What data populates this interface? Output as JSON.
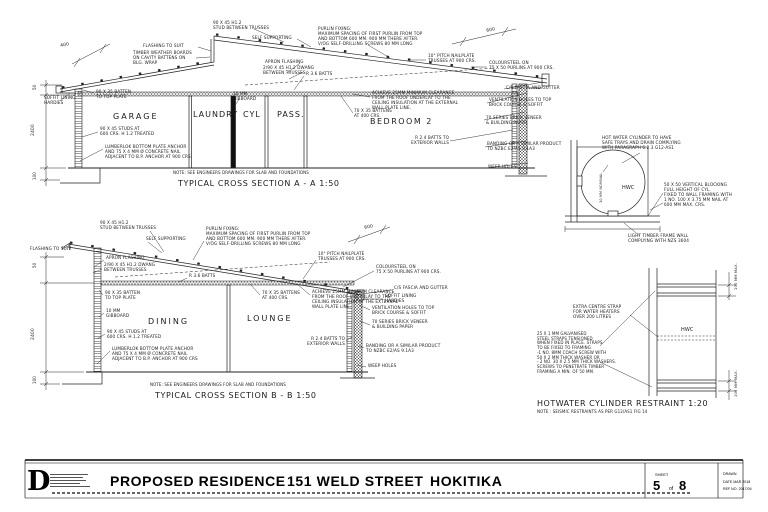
{
  "canvas": {
    "background": "#ffffff",
    "ink": "#222222"
  },
  "annotations": [
    {
      "t": "400",
      "x": 60,
      "y": 44,
      "rot": -12,
      "fs": 4.5,
      "name": "dim-400"
    },
    {
      "t": "FLASHING TO SUIT",
      "x": 143,
      "y": 44,
      "name": "note-flashing"
    },
    {
      "t": "TIMBER WEATHER BOARDS\nON CAVITY BATTENS ON\nBLG. WRAP",
      "x": 133,
      "y": 51,
      "name": "note-weatherboards"
    },
    {
      "t": "90 X 45 H1.2\nSTUD BETWEEN TRUSSES",
      "x": 213,
      "y": 21,
      "name": "note-stud-trusses"
    },
    {
      "t": "SELF SUPPORTING",
      "x": 252,
      "y": 36,
      "name": "note-self-supporting"
    },
    {
      "t": "PURLIN FIXING:\nMAXIMUM SPACING OF FIRST PURLIN FROM TOP\nAND BOTTOM 600 MM. 900 MM THERE AFTER.\nV/OG SELF-DRILLING SCREWS 80 MM LONG",
      "x": 318,
      "y": 27,
      "name": "note-purlin-fixing"
    },
    {
      "t": "600",
      "x": 486,
      "y": 29,
      "rot": -12,
      "fs": 4.5,
      "name": "dim-600"
    },
    {
      "t": "APRON FLASHING",
      "x": 265,
      "y": 60,
      "name": "note-apron-flashing"
    },
    {
      "t": "2/90 X 45 H1.2 DWANG\nBETWEEN TRUSSES",
      "x": 263,
      "y": 66,
      "name": "note-dwang"
    },
    {
      "t": "R 3.6 BATTS",
      "x": 306,
      "y": 72,
      "name": "note-ceiling-batts"
    },
    {
      "t": "10° PITCH NAILPLATE\nTRUSSES AT 900 CRS.",
      "x": 428,
      "y": 54,
      "name": "note-nailplate-trusses"
    },
    {
      "t": "COLOURSTEEL ON\n75 X 50 PURLINS AT 900 CRS.",
      "x": 489,
      "y": 61,
      "name": "note-coloursteel"
    },
    {
      "t": "C/S FASCIA AND GUTTER",
      "x": 506,
      "y": 86,
      "name": "note-fascia"
    },
    {
      "t": "VENTILATION HOLES TO TOP\nBRICK COURSE & SOFFIT",
      "x": 489,
      "y": 98,
      "name": "note-ventilation"
    },
    {
      "t": "70 SERIES BRICK VENEER\n& BUILDING PAPER",
      "x": 486,
      "y": 116,
      "name": "note-brick-veneer"
    },
    {
      "t": "R 2.4 BATTS TO\nEXTERIOR WALLS",
      "x": 411,
      "y": 136,
      "ta": "right",
      "w": 38,
      "name": "note-wall-batts"
    },
    {
      "t": "BANDING OR A SIMILAR PRODUCT\nTO NZBC E2/AS 9.1A3",
      "x": 487,
      "y": 142,
      "name": "note-banding"
    },
    {
      "t": "WEEP HOLES",
      "x": 488,
      "y": 165,
      "name": "note-weep-holes"
    },
    {
      "t": "SOFFIT LINING\nHARDIES",
      "x": 44,
      "y": 96,
      "name": "note-soffit-lining"
    },
    {
      "t": "90 X 35 BATTEN\nTO TOP PLATE",
      "x": 96,
      "y": 90,
      "name": "note-batten-top-plate"
    },
    {
      "t": "10 MM\nGIBBOARD",
      "x": 233,
      "y": 92,
      "name": "note-gibboard"
    },
    {
      "t": "70 X 35 BATTENS\nAT 400 CRS.",
      "x": 354,
      "y": 109,
      "name": "note-ceiling-battens"
    },
    {
      "t": "ACHIEVE 25MM MINIMUM CLEARANCE\nFROM THE ROOF UNDERLAY TO THE\nCEILING INSULATION AT THE EXTERNAL\nWALL PLATE LINE.",
      "x": 372,
      "y": 91,
      "name": "note-clearance"
    },
    {
      "t": "90 X 45 STUDS AT\n600 CRS. H 1.2 TREATED",
      "x": 100,
      "y": 127,
      "name": "note-studs"
    },
    {
      "t": "LUMBERLOK BOTTOM PLATE ANCHOR\nAND 75 X 4 MM Ø CONCRETE NAIL\nADJACENT TO B.P. ANCHOR AT 900 CRS",
      "x": 105,
      "y": 145,
      "name": "note-lumberlok"
    },
    {
      "t": "GARAGE",
      "x": 113,
      "y": 112,
      "fs": 8,
      "ls": 2,
      "name": "room-label-garage"
    },
    {
      "t": "LAUNDRY",
      "x": 193,
      "y": 110,
      "fs": 8,
      "ls": 1,
      "name": "room-label-laundry"
    },
    {
      "t": "CYL",
      "x": 243,
      "y": 110,
      "fs": 8,
      "ls": 1,
      "name": "room-label-cyl"
    },
    {
      "t": "PASS.",
      "x": 277,
      "y": 110,
      "fs": 8,
      "ls": 1,
      "name": "room-label-pass"
    },
    {
      "t": "BEDROOM 2",
      "x": 370,
      "y": 117,
      "fs": 8,
      "ls": 1.5,
      "name": "room-label-bedroom2"
    },
    {
      "t": "NOTE: SEE ENGINEERS DRAWINGS FOR SLAB AND FOUNDATIONS",
      "x": 173,
      "y": 171,
      "fs": 4,
      "name": "section-a-note"
    },
    {
      "t": "TYPICAL CROSS SECTION A - A 1:50",
      "x": 178,
      "y": 179,
      "fs": 8,
      "ls": 0.6,
      "name": "section-a-title"
    },
    {
      "t": "2400",
      "x": 31,
      "y": 136,
      "rot": -90,
      "fs": 4.5,
      "name": "dim-2400"
    },
    {
      "t": "100",
      "x": 33,
      "y": 180,
      "rot": -90,
      "fs": 4,
      "name": "dim-100"
    },
    {
      "t": "50",
      "x": 33,
      "y": 90,
      "rot": -90,
      "fs": 4,
      "name": "dim-50"
    },
    {
      "t": "FLASHING TO SUIT",
      "x": 30,
      "y": 247,
      "name": "note-flashing-b"
    },
    {
      "t": "90 X 45 H1.2\nSTUD BETWEEN TRUSSES",
      "x": 100,
      "y": 221,
      "name": "note-stud-trusses-b"
    },
    {
      "t": "SELF SUPPORTING",
      "x": 146,
      "y": 237,
      "name": "note-self-supporting-b"
    },
    {
      "t": "PURLIN FIXING:\nMAXIMUM SPACING OF FIRST PURLIN FROM TOP\nAND BOTTOM 600 MM. 900 MM THERE AFTER.\nV/OG SELF-DRILLING SCREWS 80 MM LONG",
      "x": 206,
      "y": 227,
      "name": "note-purlin-fixing-b"
    },
    {
      "t": "600",
      "x": 364,
      "y": 226,
      "rot": -12,
      "fs": 4.5,
      "name": "dim-600-b"
    },
    {
      "t": "10° PITCH NAILPLATE\nTRUSSES AT 900 CRS.",
      "x": 318,
      "y": 252,
      "name": "note-nailplate-trusses-b"
    },
    {
      "t": "APRON FLASHING",
      "x": 106,
      "y": 256,
      "name": "note-apron-flashing-b"
    },
    {
      "t": "2/90 X 45 H1.2 DWANG\nBETWEEN TRUSSES",
      "x": 104,
      "y": 263,
      "name": "note-dwang-b"
    },
    {
      "t": "R 3.6 BATTS",
      "x": 189,
      "y": 274,
      "name": "note-ceiling-batts-b"
    },
    {
      "t": "COLOURSTEEL ON\n75 X 50 PURLINS AT 900 CRS.",
      "x": 376,
      "y": 265,
      "name": "note-coloursteel-b"
    },
    {
      "t": "C/S FASCIA AND GUTTER",
      "x": 394,
      "y": 286,
      "name": "note-fascia-b"
    },
    {
      "t": "SOFFIT LINING\nHARDIES",
      "x": 385,
      "y": 294,
      "name": "note-soffit-lining-b"
    },
    {
      "t": "VENTILATION HOLES TO TOP\nBRICK COURSE & SOFFIT",
      "x": 372,
      "y": 306,
      "name": "note-ventilation-b"
    },
    {
      "t": "70 SERIES BRICK VENEER\n& BUILDING PAPER",
      "x": 372,
      "y": 320,
      "name": "note-brick-veneer-b"
    },
    {
      "t": "90 X 35 BATTEN\nTO TOP PLATE",
      "x": 105,
      "y": 291,
      "name": "note-batten-top-plate-b"
    },
    {
      "t": "70 X 35 BATTENS\nAT 400 CRS.",
      "x": 262,
      "y": 291,
      "name": "note-ceiling-battens-b"
    },
    {
      "t": "ACHIEVE 25MM MINIMUM CLEARANCE\nFROM THE ROOF UNDERLAY TO THE\nCEILING INSULATION AT THE EXTERNAL\nWALL PLATE LINE.",
      "x": 312,
      "y": 290,
      "name": "note-clearance-b"
    },
    {
      "t": "10 MM\nGIBBOARD",
      "x": 106,
      "y": 309,
      "name": "note-gibboard-b"
    },
    {
      "t": "DINING",
      "x": 148,
      "y": 317,
      "fs": 8,
      "ls": 2,
      "name": "room-label-dining"
    },
    {
      "t": "LOUNGE",
      "x": 247,
      "y": 314,
      "fs": 8,
      "ls": 2,
      "name": "room-label-lounge"
    },
    {
      "t": "90 X 45 STUDS AT\n600 CRS. H 1.2 TREATED",
      "x": 107,
      "y": 330,
      "name": "note-studs-b"
    },
    {
      "t": "LUMBERLOK BOTTOM PLATE ANCHOR\nAND 75 X 4 MM Ø CONCRETE NAIL\nADJACENT TO B.P. ANCHOR AT 900 CRS",
      "x": 112,
      "y": 347,
      "name": "note-lumberlok-b"
    },
    {
      "t": "R 2.4 BATTS TO\nEXTERIOR WALLS",
      "x": 303,
      "y": 337,
      "ta": "right",
      "w": 42,
      "name": "note-wall-batts-b"
    },
    {
      "t": "BANDING OR A SIMILAR PRODUCT\nTO NZBC E2/AS 9.1A3",
      "x": 366,
      "y": 344,
      "name": "note-banding-b"
    },
    {
      "t": "WEEP HOLES",
      "x": 368,
      "y": 364,
      "name": "note-weep-holes-b"
    },
    {
      "t": "NOTE: SEE ENGINEERS DRAWINGS FOR SLAB AND FOUNDATIONS",
      "x": 150,
      "y": 383,
      "fs": 4,
      "name": "section-b-note"
    },
    {
      "t": "TYPICAL CROSS SECTION B - B 1:50",
      "x": 155,
      "y": 391,
      "fs": 8,
      "ls": 0.6,
      "name": "section-b-title"
    },
    {
      "t": "2400",
      "x": 31,
      "y": 340,
      "rot": -90,
      "fs": 4.5,
      "name": "dim-2400-b"
    },
    {
      "t": "100",
      "x": 33,
      "y": 384,
      "rot": -90,
      "fs": 4,
      "name": "dim-100-b"
    },
    {
      "t": "50",
      "x": 33,
      "y": 268,
      "rot": -90,
      "fs": 4,
      "name": "dim-50-b"
    },
    {
      "t": "HOT WATER CYLINDER TO HAVE\nSAFE TRAYS AND DRAIN COMPLYING\nWITH PARAGRAPH 6.2.3 G12-AS1",
      "x": 602,
      "y": 136,
      "name": "note-hwc-tray"
    },
    {
      "t": "HWC",
      "x": 622,
      "y": 186,
      "fs": 5,
      "name": "hwc-label"
    },
    {
      "t": "10 MM NOMINAL",
      "x": 599,
      "y": 203,
      "rot": -90,
      "fs": 3.5,
      "name": "note-nominal-gap"
    },
    {
      "t": "50 X 50 VERTICAL BLOCKING\nFULL HEIGHT OF CYL.\nFIXED TO WALL FRAMING WITH\n1 NO. 100 X 3.75 MM NAIL AT\n600 MM MAX. CRS.",
      "x": 664,
      "y": 183,
      "name": "note-blocking"
    },
    {
      "t": "LIGHT TIMBER FRAME WALL\nCOMPLYING WITH NZS 3604",
      "x": 628,
      "y": 234,
      "name": "note-ltf-wall"
    },
    {
      "t": "EXTRA CENTRE STRAP\nFOR WATER HEATERS\nOVER 200 LITRES",
      "x": 573,
      "y": 305,
      "name": "note-centre-strap"
    },
    {
      "t": "25 X 1 MM GALVANISED\nSTEEL STRAPS TENSIONED\nWHEN FIXED IN PLACE. STRAPS\nTO BE FIXED TO FRAMING\n-1 NO. 8MM COACH SCREW WITH\n50 X 2 MM THICK WASHER OR\n- 2 NO. 30 X 2.5 MM THICK WASHERS.\nSCREWS TO PENETRATE TIMBER\nFRAMING A MIN. OF 50 MM.",
      "x": 537,
      "y": 332,
      "fs": 4,
      "name": "note-straps"
    },
    {
      "t": "HWC",
      "x": 681,
      "y": 328,
      "fs": 5,
      "name": "hwc-label-2"
    },
    {
      "t": "100 MM MAX.",
      "x": 734,
      "y": 290,
      "rot": -90,
      "fs": 3.8,
      "name": "dim-100max-top"
    },
    {
      "t": "100 MM MAX.",
      "x": 734,
      "y": 397,
      "rot": -90,
      "fs": 3.8,
      "name": "dim-100max-bottom"
    },
    {
      "t": "HOTWATER CYLINDER RESTRAINT 1:20",
      "x": 537,
      "y": 399,
      "fs": 8,
      "ls": 0.5,
      "name": "restraint-title"
    },
    {
      "t": "NOTE : SEISMIC RESTRAINTS AS PER G12/AS1 FIG 14",
      "x": 537,
      "y": 410,
      "fs": 4,
      "name": "restraint-note"
    }
  ],
  "titleblock": {
    "logo": "D",
    "project": "PROPOSED RESIDENCE",
    "street": "151 WELD STREET",
    "city": "HOKITIKA",
    "sheet_label": "SHEET",
    "sheet_no": "5",
    "of_label": "of",
    "sheet_total": "8",
    "drawn_label": "DRAWN",
    "date_label": "DATE MAR 2018",
    "ref_label": "REF NO. 2017/04"
  }
}
